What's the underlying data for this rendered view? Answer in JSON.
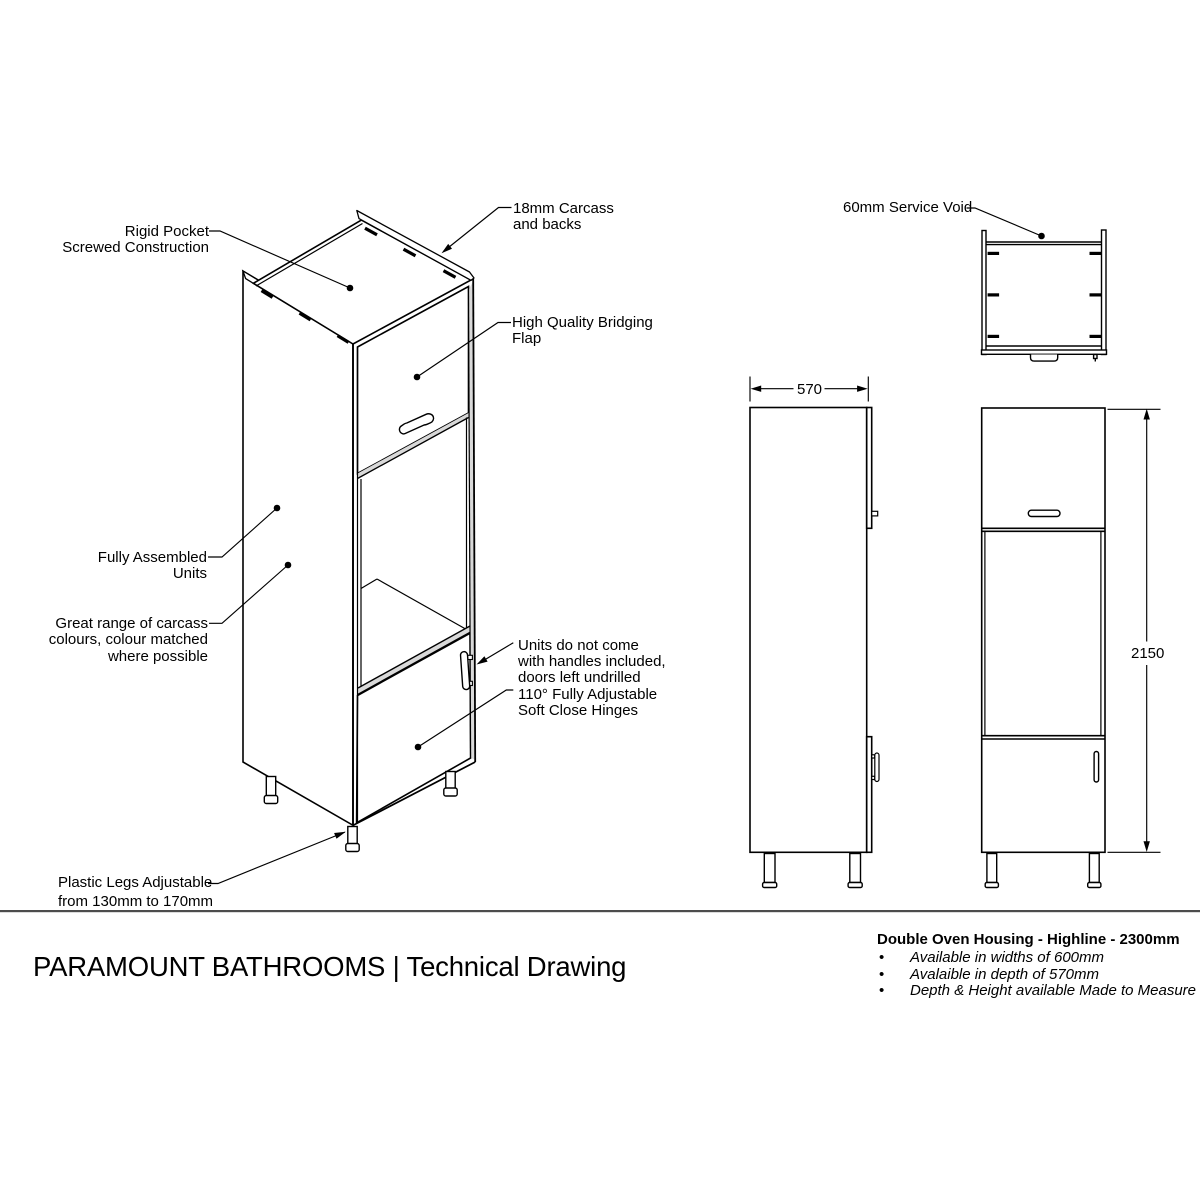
{
  "page": {
    "background": "#ffffff"
  },
  "drawing": {
    "colors": {
      "line": "#000000",
      "shade": "#d9d9d9",
      "separator": "#4c4c4c"
    },
    "annotations": {
      "rigid_pocket": [
        "Rigid Pocket",
        "Screwed Construction"
      ],
      "carcass": [
        "18mm Carcass",
        "and backs"
      ],
      "bridging_flap": [
        "High Quality Bridging",
        "Flap"
      ],
      "fully_assembled": [
        "Fully Assembled",
        "Units"
      ],
      "carcass_colours": [
        "Great range of carcass",
        "colours, colour matched",
        "where possible"
      ],
      "handles_hinges": [
        "Units do not come",
        "with handles included,",
        "doors left undrilled",
        "110° Fully Adjustable",
        "Soft Close Hinges"
      ],
      "plastic_legs": [
        "Plastic Legs Adjustable",
        "from 130mm to 170mm"
      ],
      "service_void": "60mm Service Void"
    },
    "dimensions": {
      "depth_mm": "570",
      "height_mm": "2150"
    }
  },
  "footer": {
    "title": "PARAMOUNT BATHROOMS | Technical Drawing"
  },
  "specs": {
    "heading": "Double Oven Housing - Highline - 2300mm",
    "bullet_char": "•",
    "items": [
      "Available in widths of 600mm",
      "Avalaible in depth of 570mm",
      "Depth & Height available Made to Measure"
    ]
  }
}
